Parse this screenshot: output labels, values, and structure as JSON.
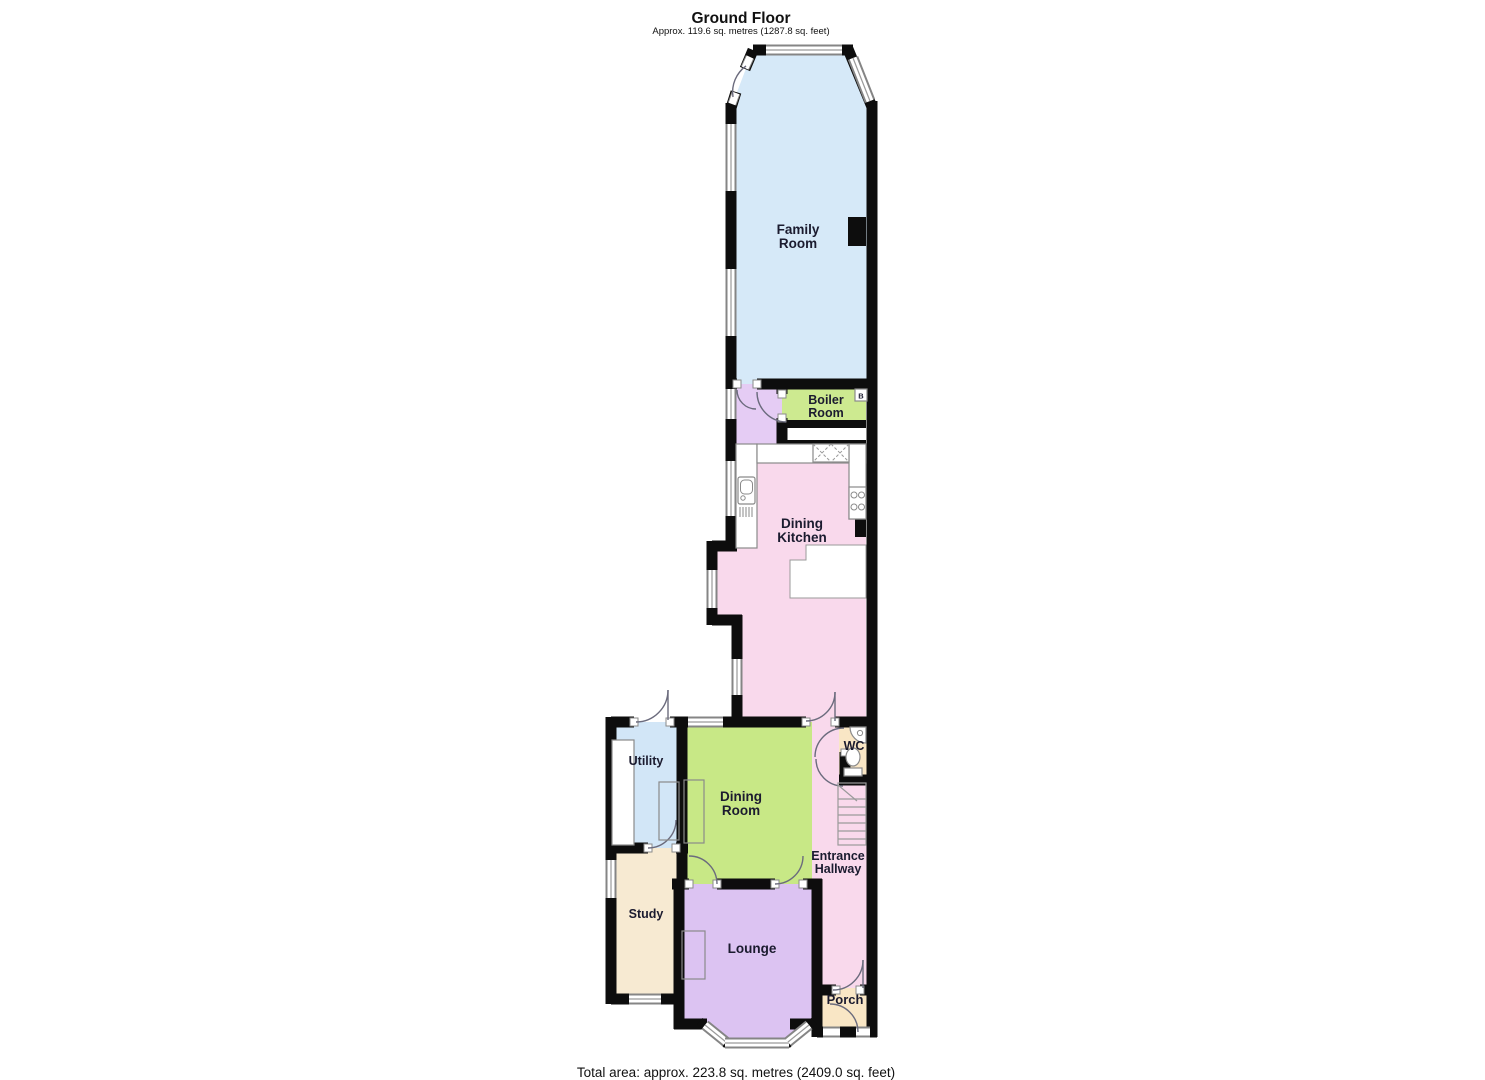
{
  "header": {
    "title": "Ground Floor",
    "subtitle": "Approx. 119.6 sq. metres (1287.8 sq. feet)"
  },
  "footer": {
    "total_area": "Total area: approx. 223.8 sq. metres (2409.0 sq. feet)"
  },
  "rooms": {
    "family_room": {
      "label": [
        "Family",
        "Room"
      ]
    },
    "boiler_room": {
      "label": [
        "Boiler",
        "Room"
      ]
    },
    "dining_kitchen": {
      "label": [
        "Dining",
        "Kitchen"
      ]
    },
    "utility": {
      "label": [
        "Utility"
      ]
    },
    "dining_room": {
      "label": [
        "Dining",
        "Room"
      ]
    },
    "wc": {
      "label": [
        "WC"
      ]
    },
    "entrance_hallway": {
      "label": [
        "Entrance",
        "Hallway"
      ]
    },
    "study": {
      "label": [
        "Study"
      ]
    },
    "lounge": {
      "label": [
        "Lounge"
      ]
    },
    "porch": {
      "label": [
        "Porch"
      ]
    }
  },
  "markers": {
    "boiler_unit": "B"
  },
  "colors": {
    "wall": "#0d0d0d",
    "family_room": "#d6e9f8",
    "lobby": "#e5ccf4",
    "boiler_room": "#cdea90",
    "dining_kitchen": "#f9d9ec",
    "utility": "#d2e6f7",
    "dining_room": "#c8e886",
    "wc": "#f9e6c5",
    "entrance_hallway": "#f9d9ec",
    "study": "#f7ead2",
    "lounge": "#dcc3f2",
    "porch": "#f9e6c5",
    "label_text": "#1b1b2f"
  }
}
